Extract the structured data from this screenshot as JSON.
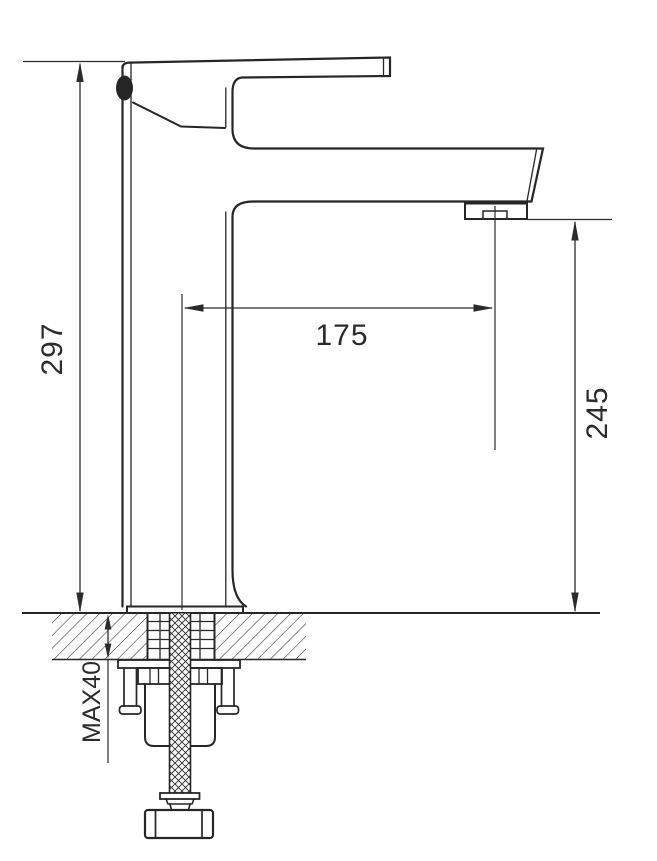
{
  "drawing": {
    "background": "#ffffff",
    "line_color": "#262626",
    "subject": "single-lever basin faucet side elevation with deck mounting cross-section",
    "dimensions": {
      "overall_height": {
        "value": "297",
        "orientation": "vertical",
        "side": "left"
      },
      "spout_reach": {
        "value": "175",
        "orientation": "horizontal",
        "side": "middle"
      },
      "spout_height": {
        "value": "245",
        "orientation": "vertical",
        "side": "right"
      },
      "deck_thickness": {
        "value": "MAX40",
        "orientation": "vertical",
        "side": "bottom-left"
      }
    }
  }
}
